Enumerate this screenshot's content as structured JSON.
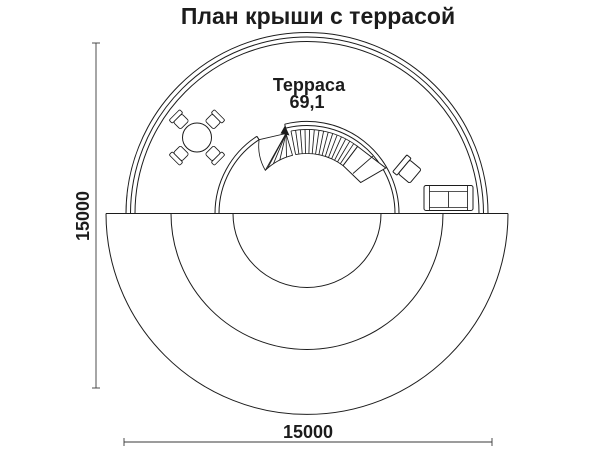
{
  "title": "План крыши с террасой",
  "terrace": {
    "name": "Терраса",
    "area": "69,1"
  },
  "dimensions": {
    "vertical": "15000",
    "horizontal": "15000"
  },
  "colors": {
    "ink": "#1c1c1c",
    "paper": "#ffffff"
  }
}
